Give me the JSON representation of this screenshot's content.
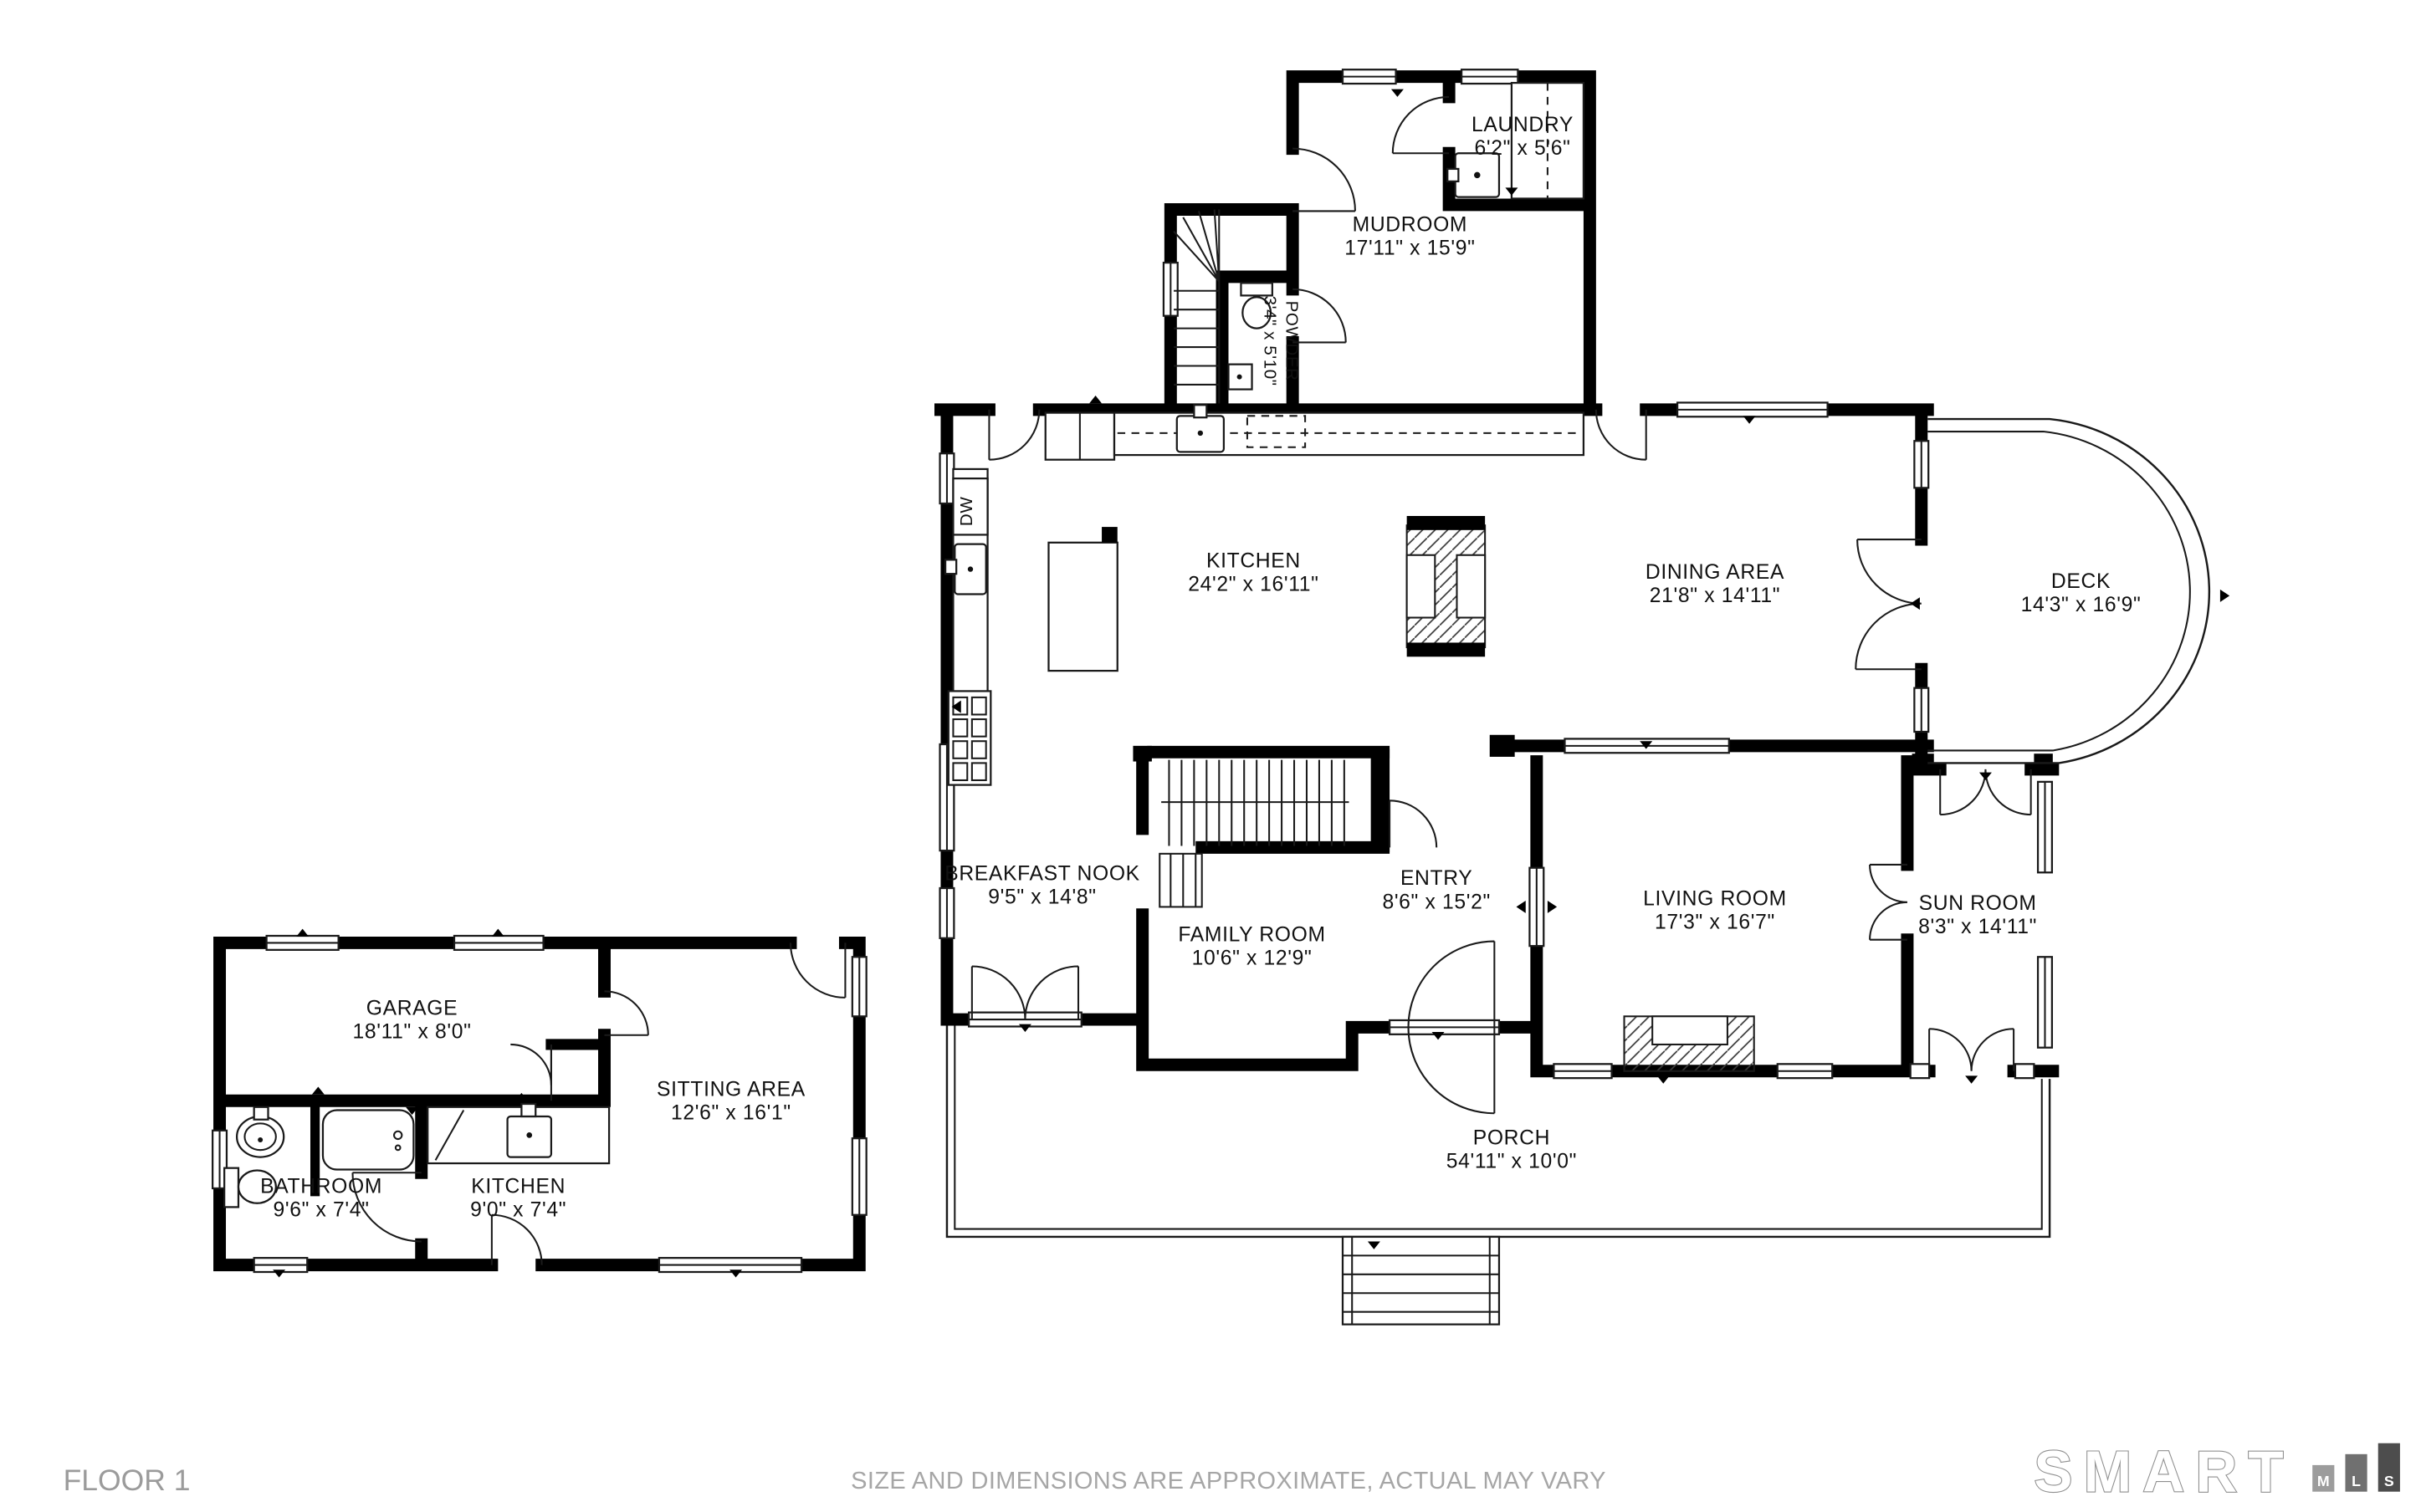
{
  "page": {
    "background": "#ffffff"
  },
  "rooms": {
    "laundry": {
      "name": "LAUNDRY",
      "dims": "6'2\" x 5'6\""
    },
    "mudroom": {
      "name": "MUDROOM",
      "dims": "17'11\" x 15'9\""
    },
    "powder": {
      "name": "POWDER",
      "dims": "3'4\" x 5'10\""
    },
    "kitchen": {
      "name": "KITCHEN",
      "dims": "24'2\" x 16'11\""
    },
    "dining": {
      "name": "DINING AREA",
      "dims": "21'8\" x 14'11\""
    },
    "deck": {
      "name": "DECK",
      "dims": "14'3\" x 16'9\""
    },
    "breakfast": {
      "name": "BREAKFAST NOOK",
      "dims": "9'5\" x 14'8\""
    },
    "entry": {
      "name": "ENTRY",
      "dims": "8'6\" x 15'2\""
    },
    "family": {
      "name": "FAMILY ROOM",
      "dims": "10'6\" x 12'9\""
    },
    "living": {
      "name": "LIVING ROOM",
      "dims": "17'3\" x 16'7\""
    },
    "sunroom": {
      "name": "SUN ROOM",
      "dims": "8'3\" x 14'11\""
    },
    "porch": {
      "name": "PORCH",
      "dims": "54'11\" x 10'0\""
    },
    "garage": {
      "name": "GARAGE",
      "dims": "18'11\" x 8'0\""
    },
    "sitting": {
      "name": "SITTING AREA",
      "dims": "12'6\" x 16'1\""
    },
    "bathroom": {
      "name": "BATHROOM",
      "dims": "9'6\" x 7'4\""
    },
    "kitchen2": {
      "name": "KITCHEN",
      "dims": "9'0\" x 7'4\""
    }
  },
  "fixtures": {
    "dishwasher": "DW"
  },
  "footer": {
    "floor_label": "FLOOR 1",
    "disclaimer": "SIZE AND DIMENSIONS ARE APPROXIMATE, ACTUAL MAY VARY",
    "brand": {
      "wordmark": "SMART",
      "blocks": [
        {
          "letter": "M",
          "color": "#9c9c9c"
        },
        {
          "letter": "L",
          "color": "#707070"
        },
        {
          "letter": "S",
          "color": "#4d4d4d"
        }
      ]
    }
  },
  "colors": {
    "wall": "#000000",
    "label": "#111111",
    "footer_text": "#9b9b9b"
  }
}
